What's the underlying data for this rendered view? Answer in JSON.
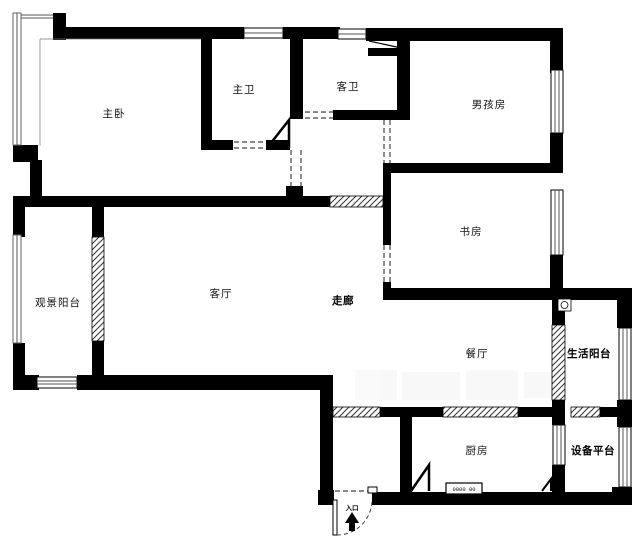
{
  "document": {
    "type": "apartment-floor-plan"
  },
  "rooms": {
    "master_bedroom": "主卧",
    "master_bath": "主卫",
    "guest_bath": "客卫",
    "boys_room": "男孩房",
    "study": "书房",
    "view_balcony": "观景阳台",
    "living_room": "客厅",
    "corridor": "走廊",
    "dining_room": "餐厅",
    "life_balcony": "生活阳台",
    "kitchen": "厨房",
    "equipment_platform": "设备平台"
  },
  "entrance": {
    "label": "入口"
  },
  "appliances": {
    "stove_label": "0000 00"
  },
  "colors": {
    "wall": "#000000",
    "window_line": "#555555",
    "hatch_line": "#333333",
    "dash_line": "#444444",
    "background": "#ffffff",
    "label": "#111111"
  }
}
